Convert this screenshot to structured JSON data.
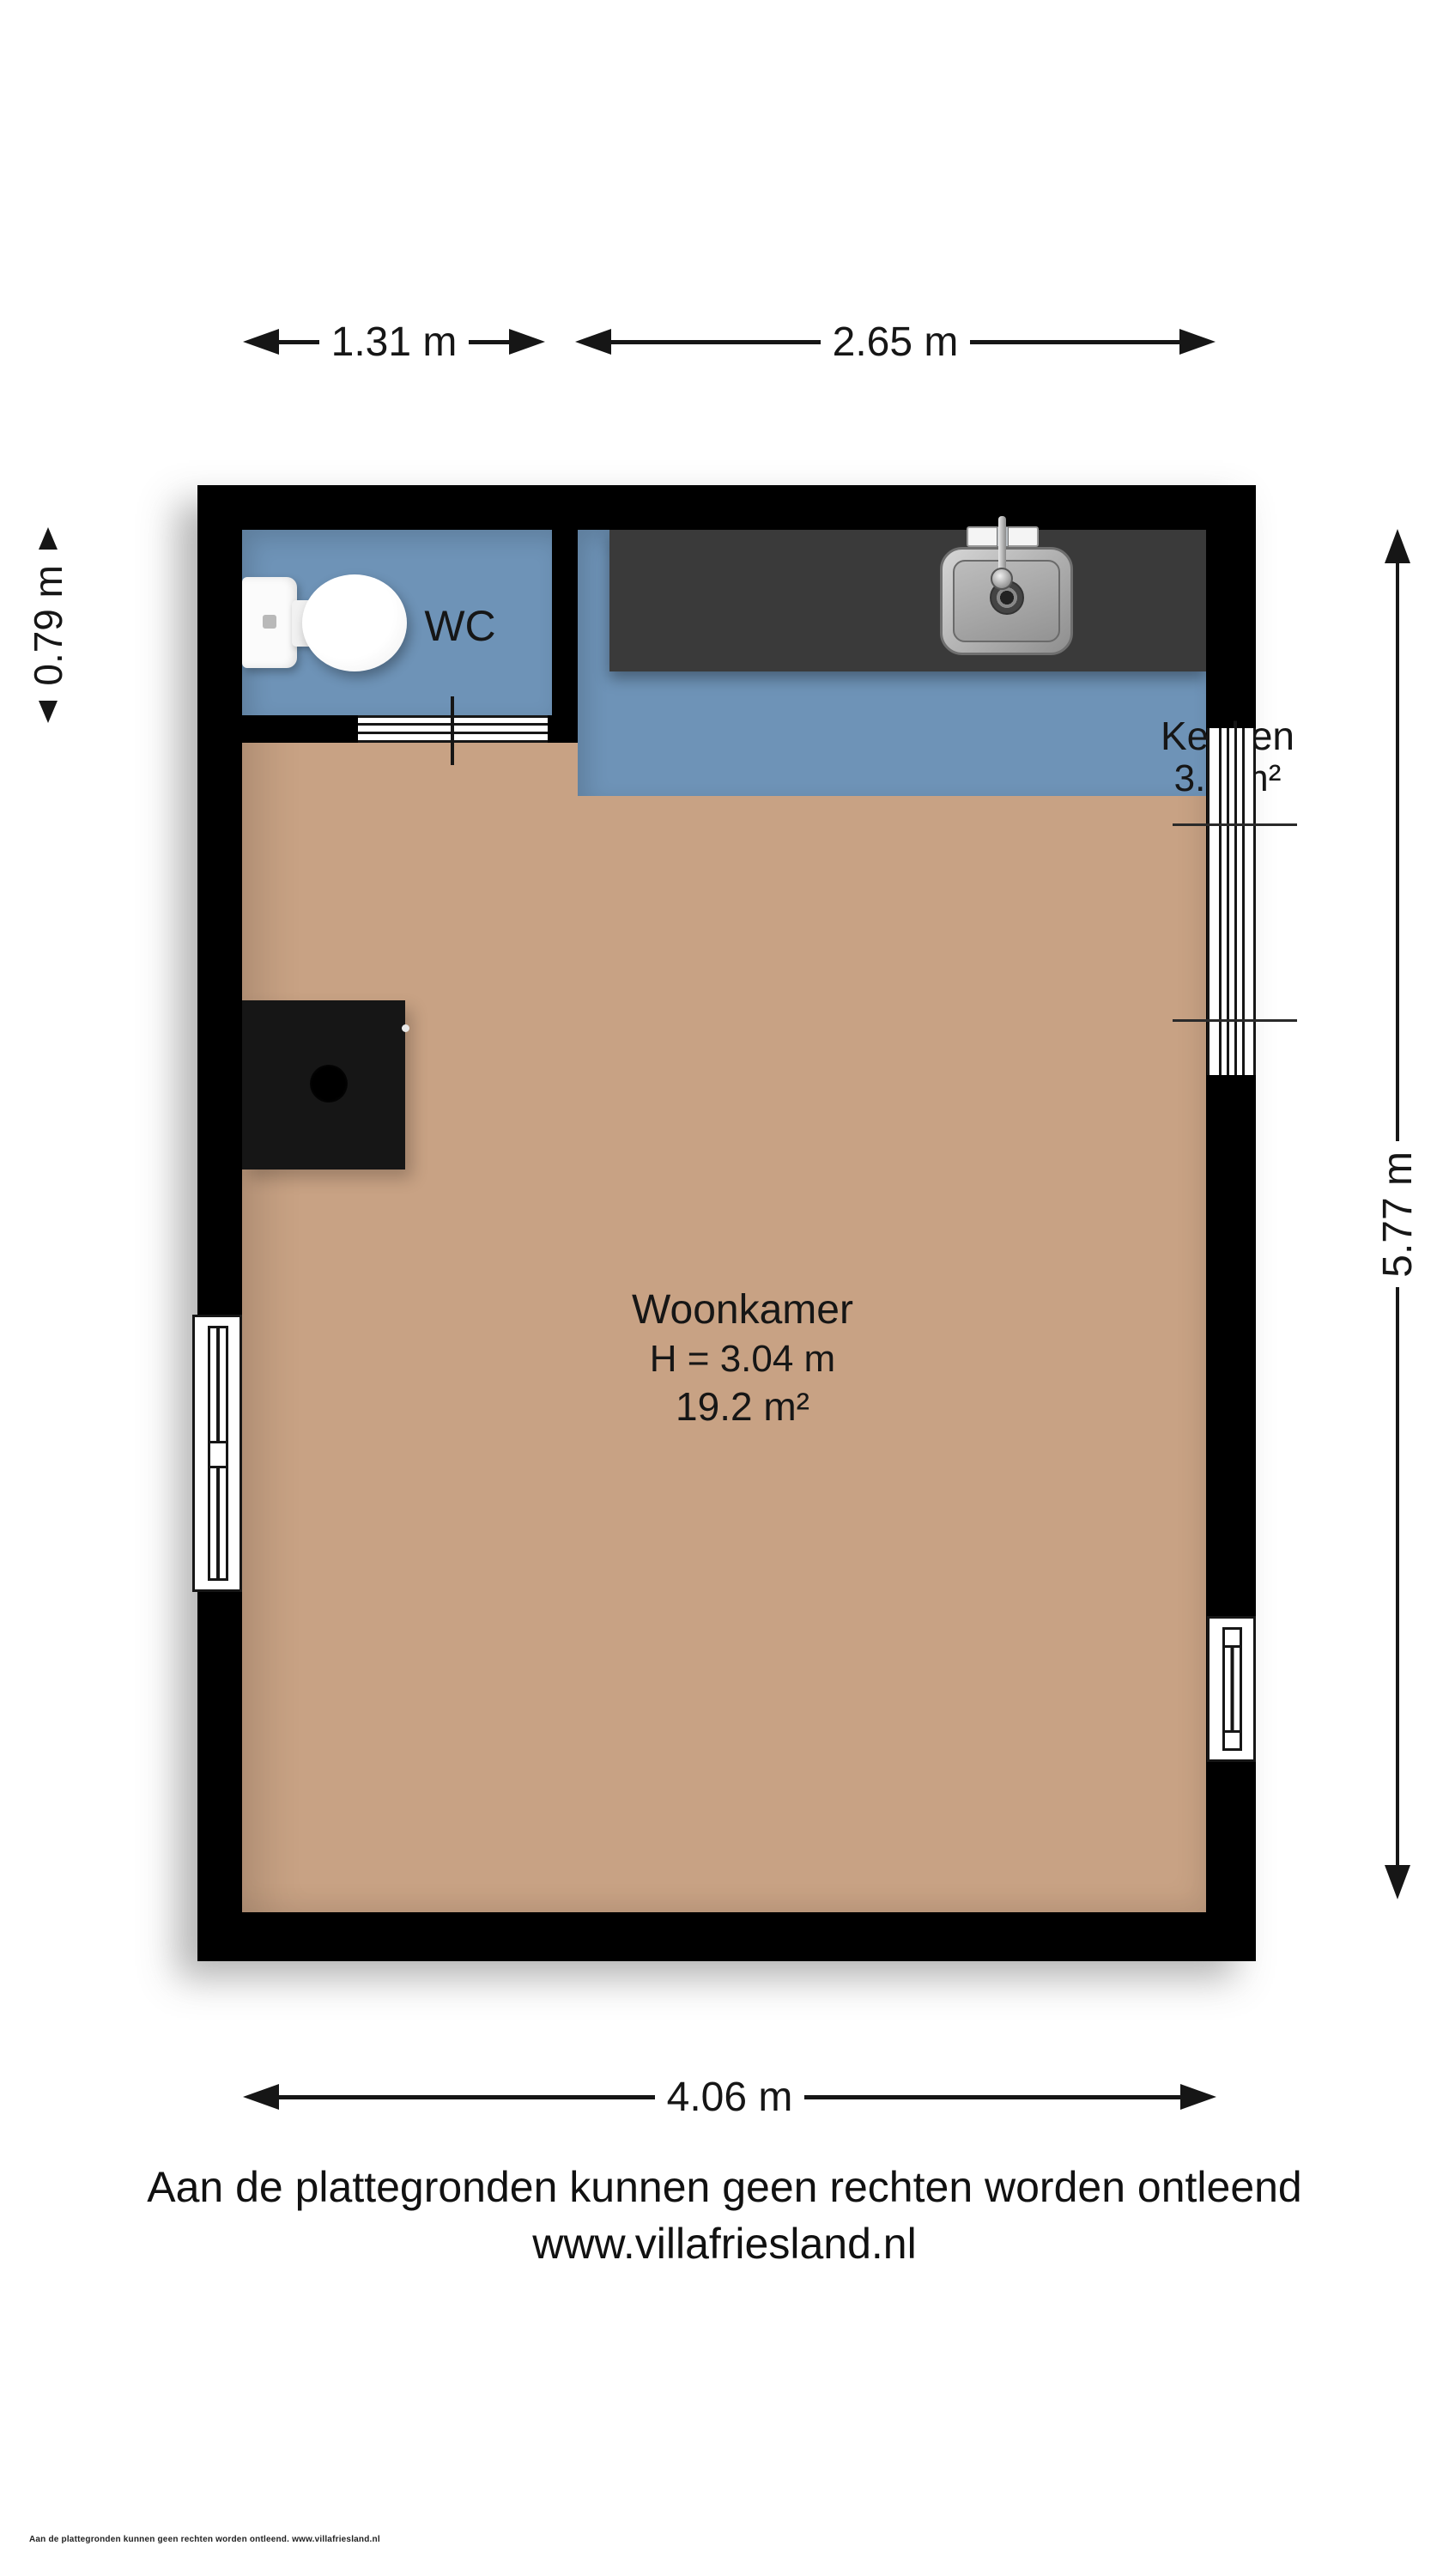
{
  "dimensions": {
    "wc_width": "1.31 m",
    "keuken_width": "2.65 m",
    "wc_height": "0.79 m",
    "right_height": "5.77 m",
    "bottom_width": "4.06 m"
  },
  "rooms": {
    "wc": {
      "label": "WC",
      "color": "#6e93b7"
    },
    "keuken": {
      "label": "Keuken",
      "area": "3.0 m²",
      "color": "#6e93b7"
    },
    "woonkamer": {
      "label": "Woonkamer",
      "ceiling_height": "H = 3.04 m",
      "area": "19.2 m²",
      "color": "#c8a284"
    }
  },
  "footer": {
    "disclaimer": "Aan de plattegronden kunnen geen rechten worden ontleend",
    "website": "www.villafriesland.nl",
    "fine_print": "Aan de plattegronden kunnen geen rechten worden ontleend. www.villafriesland.nl"
  },
  "colors": {
    "room_blue": "#6e93b7",
    "floor_beige": "#c8a284",
    "counter_dark": "#3a3a3a",
    "wall_black": "#000000",
    "text_dark": "#161616",
    "background": "#ffffff"
  }
}
